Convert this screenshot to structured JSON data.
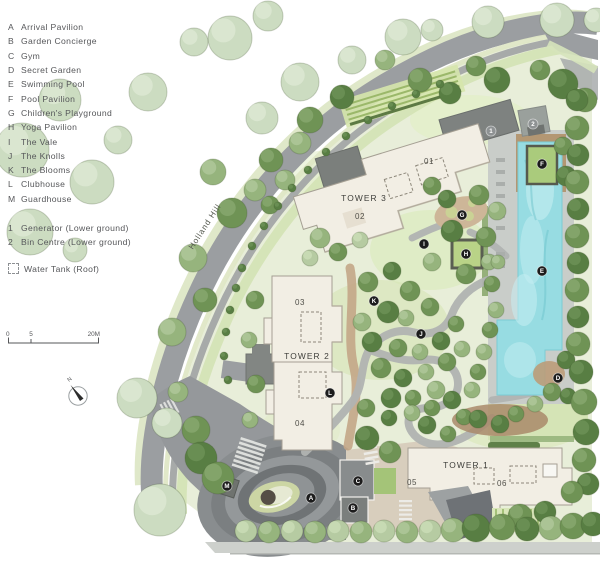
{
  "legend": {
    "items": [
      {
        "key": "A",
        "label": "Arrival Pavilion"
      },
      {
        "key": "B",
        "label": "Garden Concierge"
      },
      {
        "key": "C",
        "label": "Gym"
      },
      {
        "key": "D",
        "label": "Secret Garden"
      },
      {
        "key": "E",
        "label": "Swimming Pool"
      },
      {
        "key": "F",
        "label": "Pool Pavilion"
      },
      {
        "key": "G",
        "label": "Children's Playground"
      },
      {
        "key": "H",
        "label": "Yoga Pavilion"
      },
      {
        "key": "I",
        "label": "The Vale"
      },
      {
        "key": "J",
        "label": "The Knolls"
      },
      {
        "key": "K",
        "label": "The Blooms"
      },
      {
        "key": "L",
        "label": "Clubhouse"
      },
      {
        "key": "M",
        "label": "Guardhouse"
      }
    ],
    "numbered": [
      {
        "key": "1",
        "label": "Generator (Lower ground)"
      },
      {
        "key": "2",
        "label": "Bin Centre (Lower ground)"
      }
    ],
    "water_tank_label": "Water Tank (Roof)"
  },
  "scale_bar": {
    "ticks": [
      "0",
      "5",
      "20M"
    ]
  },
  "compass": {
    "north_label": "N"
  },
  "map": {
    "street_label": {
      "text": "Holland Hill"
    },
    "towers": [
      {
        "name": "TOWER 3",
        "x": 364,
        "y": 201,
        "units": [
          {
            "text": "01",
            "x": 429,
            "y": 164
          },
          {
            "text": "02",
            "x": 360,
            "y": 219
          }
        ]
      },
      {
        "name": "TOWER 2",
        "x": 307,
        "y": 359,
        "units": [
          {
            "text": "03",
            "x": 300,
            "y": 305
          },
          {
            "text": "04",
            "x": 300,
            "y": 426
          }
        ]
      },
      {
        "name": "TOWER 1",
        "x": 466,
        "y": 468,
        "units": [
          {
            "text": "05",
            "x": 412,
            "y": 485
          },
          {
            "text": "06",
            "x": 502,
            "y": 486
          }
        ]
      }
    ],
    "markers": [
      {
        "label": "A",
        "x": 311,
        "y": 498,
        "style": "black"
      },
      {
        "label": "B",
        "x": 353,
        "y": 508,
        "style": "black"
      },
      {
        "label": "C",
        "x": 358,
        "y": 481,
        "style": "black"
      },
      {
        "label": "D",
        "x": 558,
        "y": 378,
        "style": "black"
      },
      {
        "label": "E",
        "x": 542,
        "y": 271,
        "style": "black"
      },
      {
        "label": "F",
        "x": 542,
        "y": 164,
        "style": "black"
      },
      {
        "label": "G",
        "x": 462,
        "y": 215,
        "style": "black"
      },
      {
        "label": "H",
        "x": 466,
        "y": 254,
        "style": "black"
      },
      {
        "label": "I",
        "x": 424,
        "y": 244,
        "style": "black"
      },
      {
        "label": "J",
        "x": 421,
        "y": 334,
        "style": "black"
      },
      {
        "label": "K",
        "x": 374,
        "y": 301,
        "style": "black"
      },
      {
        "label": "L",
        "x": 330,
        "y": 393,
        "style": "black"
      },
      {
        "label": "M",
        "x": 227,
        "y": 486,
        "style": "black"
      },
      {
        "label": "1",
        "x": 491,
        "y": 131,
        "style": "gray"
      },
      {
        "label": "2",
        "x": 533,
        "y": 124,
        "style": "gray"
      }
    ],
    "colors": {
      "marker_black": "#1c1c1c",
      "marker_gray": "#8e9293",
      "road": "#9b9ea1",
      "pool": "#97dce2",
      "building": "#f2eee4",
      "site_green": "#e8eed9"
    }
  }
}
